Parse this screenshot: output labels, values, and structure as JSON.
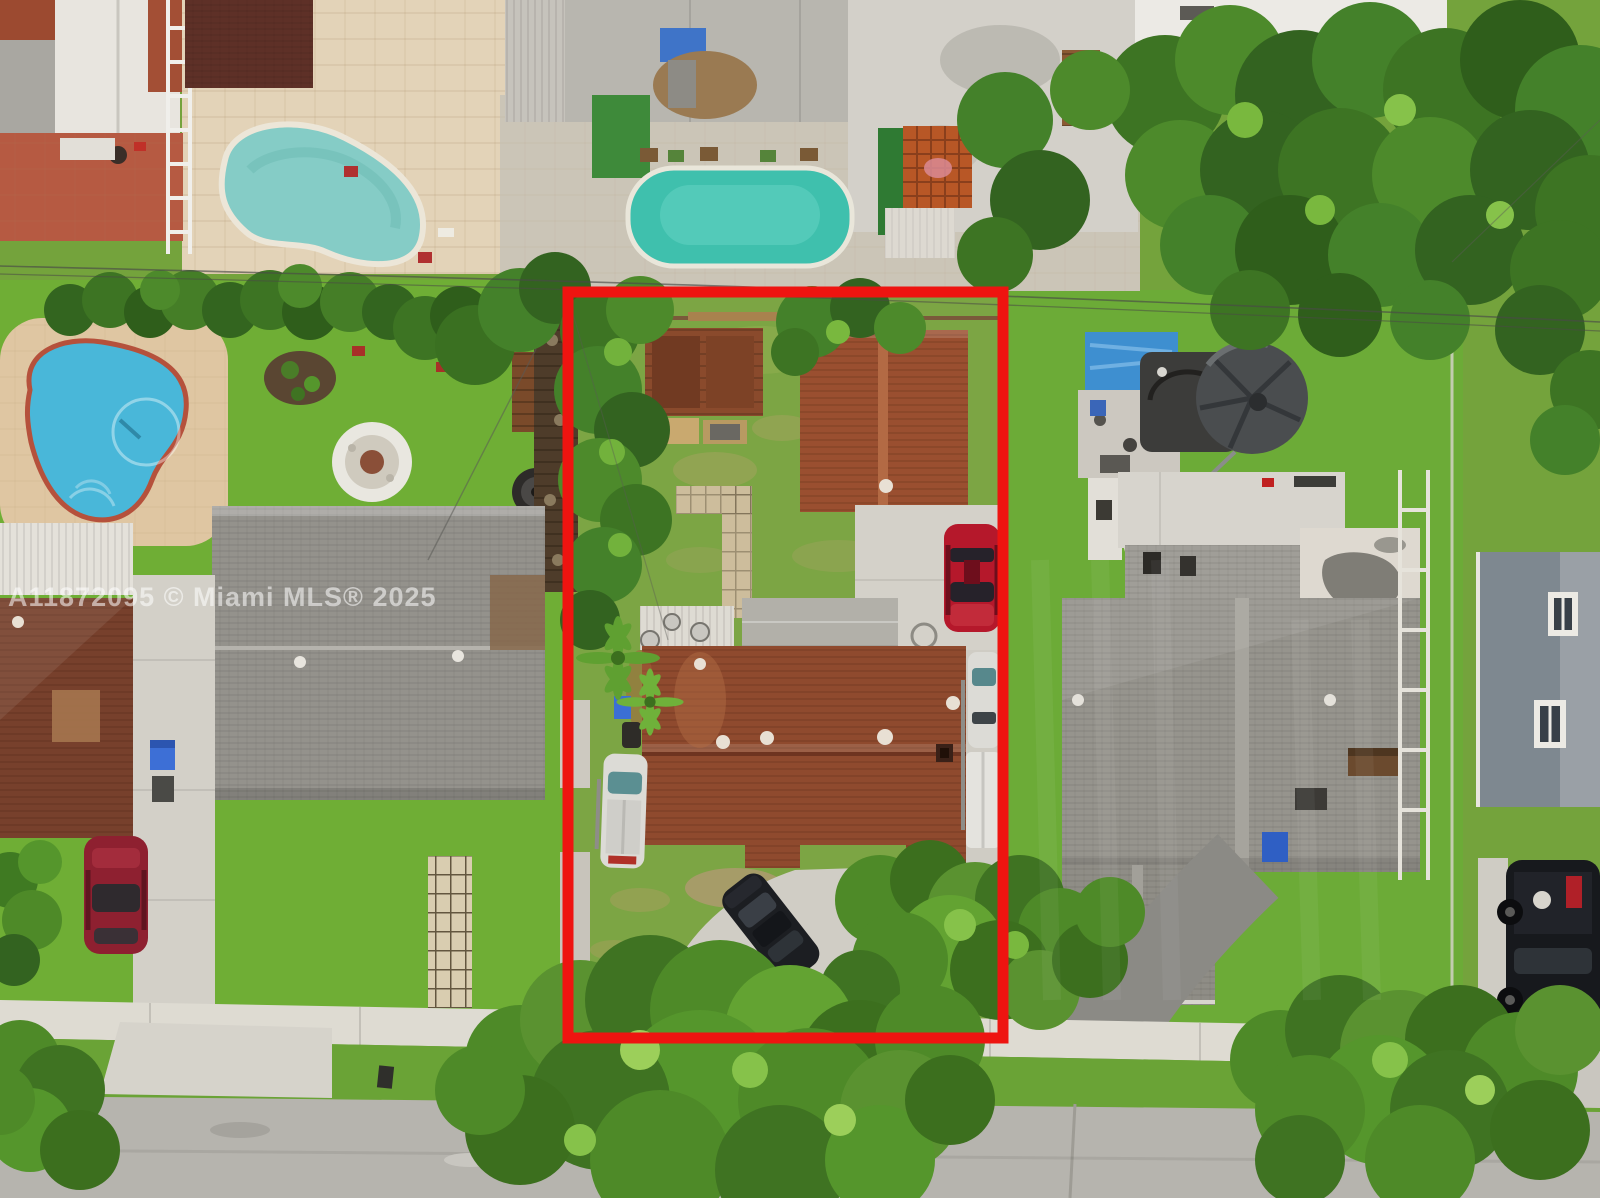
{
  "meta": {
    "type": "aerial-drone-photo",
    "subject": "residential property with red lot boundary outline"
  },
  "watermark": {
    "text": "A11872095 © Miami MLS® 2025",
    "color": "rgba(255,255,255,0.55)"
  },
  "boundary": {
    "color": "#ee1410",
    "x": 568,
    "y": 292,
    "width": 435,
    "height": 746,
    "stroke_width": 11
  },
  "palette": {
    "grass": "#74a33c",
    "grass_bright": "#6fae35",
    "street": "#b6b4ae",
    "sidewalk": "#dedbd2",
    "concrete": "#d3d0c8",
    "asphalt": "#8b8a85",
    "deck_tan": "#e3d3b8",
    "pool_teal": "#85ccc6",
    "pool_blue": "#49b7d9",
    "pool_turquoise": "#3fc0ad",
    "roof_rust": "#8f4a2e",
    "roof_garage_rust": "#9a4f30",
    "roof_maroon": "#5e3027",
    "roof_gray": "#96948d",
    "roof_white": "#e8e5df",
    "car_red": "#b5182b",
    "car_dark_red": "#8e2030",
    "vehicle_white": "#dcdbd6",
    "vehicle_black": "#1c1e22",
    "tarp_blue": "#3e8fd0"
  }
}
